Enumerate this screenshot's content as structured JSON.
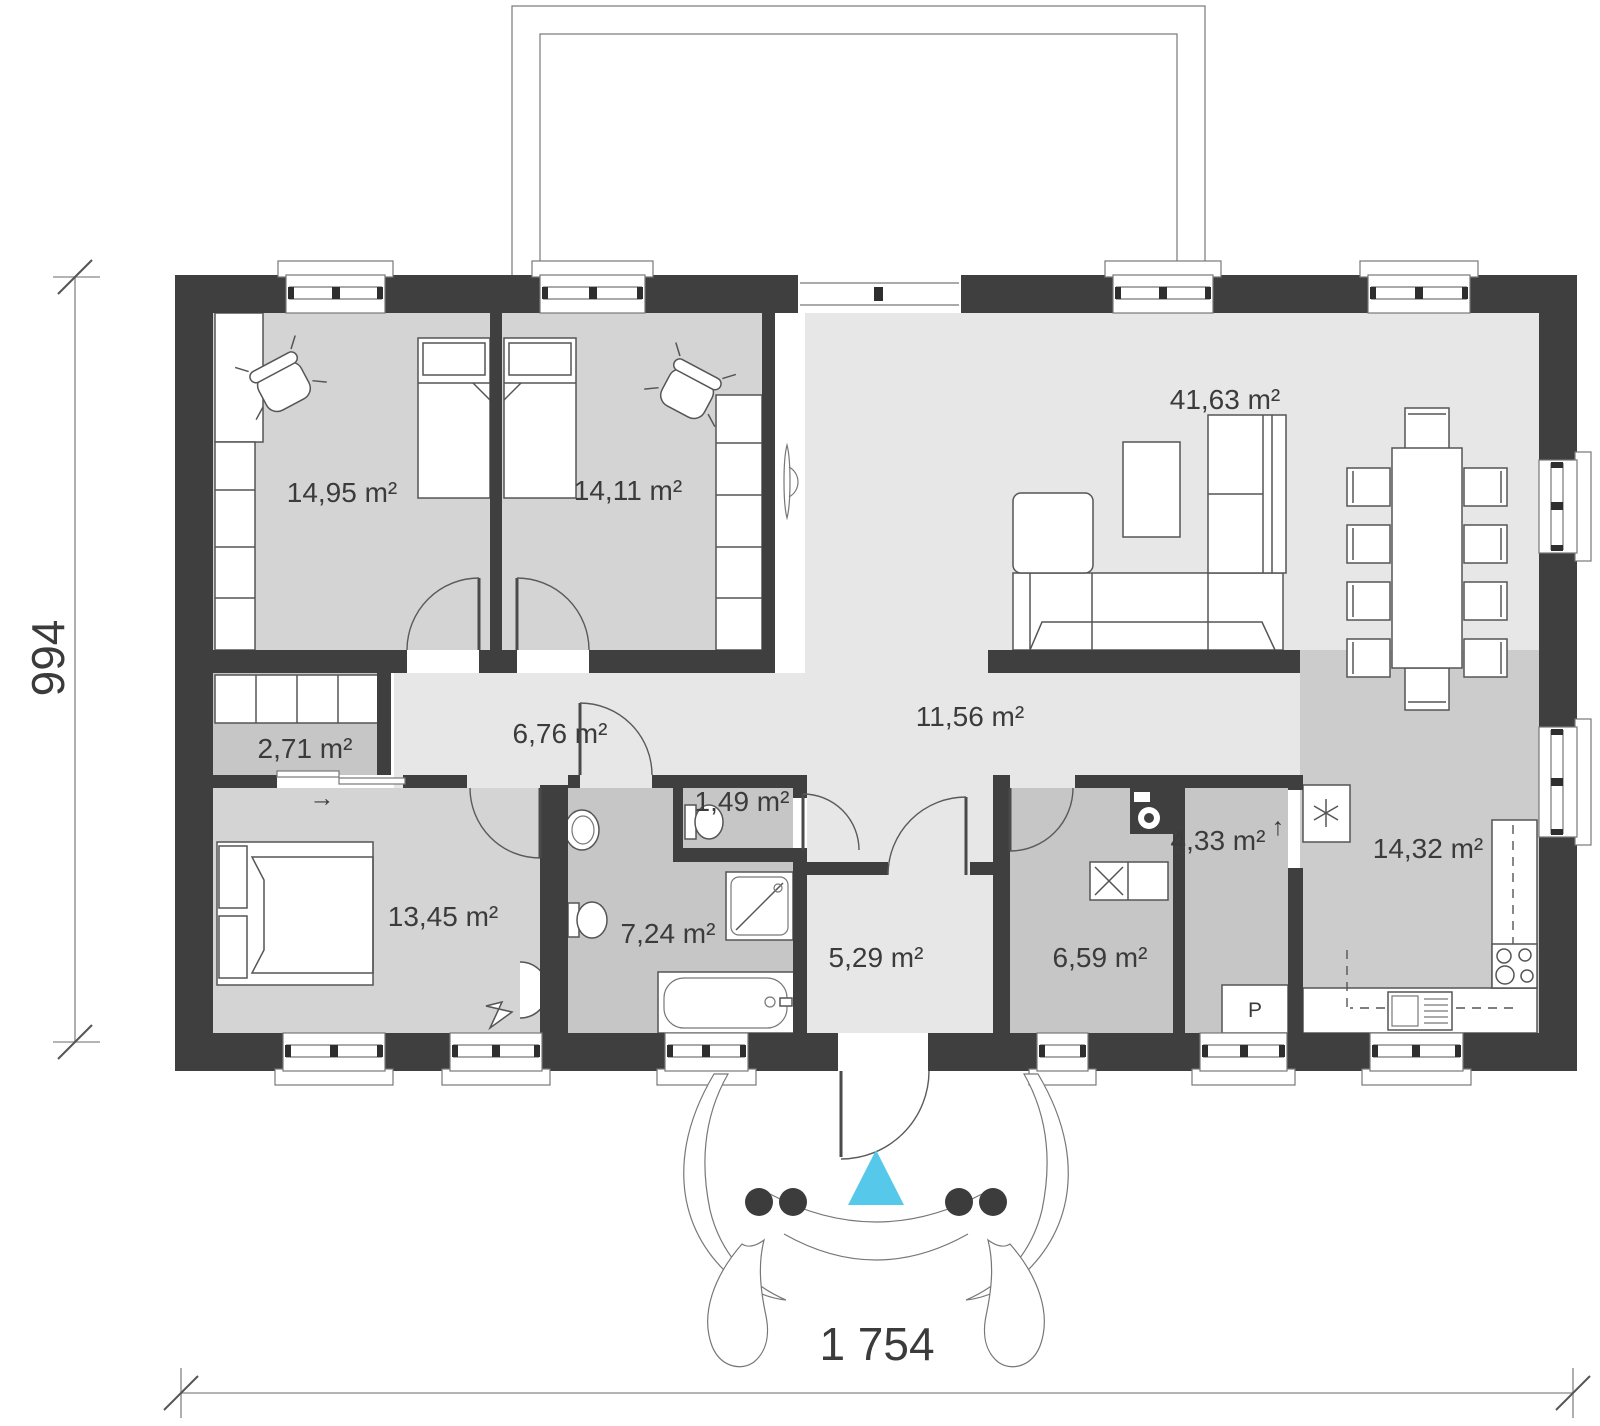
{
  "drawing": {
    "kind": "house floor plan",
    "rooms": [
      {
        "id": "bedroom-1",
        "area_label": "14,95 m²"
      },
      {
        "id": "bedroom-2",
        "area_label": "14,11 m²"
      },
      {
        "id": "living-dining",
        "area_label": "41,63 m²"
      },
      {
        "id": "wardrobe",
        "area_label": "2,71 m²"
      },
      {
        "id": "corridor",
        "area_label": "6,76 m²"
      },
      {
        "id": "hall",
        "area_label": "11,56 m²"
      },
      {
        "id": "wc",
        "area_label": "1,49 m²"
      },
      {
        "id": "master-bedroom",
        "area_label": "13,45 m²"
      },
      {
        "id": "bathroom",
        "area_label": "7,24 m²"
      },
      {
        "id": "entry",
        "area_label": "5,29 m²"
      },
      {
        "id": "utility",
        "area_label": "6,59 m²"
      },
      {
        "id": "pantry",
        "area_label": "4,33 m²"
      },
      {
        "id": "kitchen",
        "area_label": "14,32 m²"
      }
    ],
    "dimensions": {
      "overall_width": "1 754",
      "overall_depth": "994"
    },
    "symbols": {
      "pantry_cabinet": "P",
      "wardrobe_slide_arrow": "→",
      "pantry_arrow": "↑"
    },
    "icons": [
      {
        "name": "entrance-marker-icon",
        "shape": "triangle"
      },
      {
        "name": "fridge-icon",
        "shape": "asterisk"
      },
      {
        "name": "washing-machine-icon",
        "shape": "dark square with circle"
      },
      {
        "name": "stove-icon",
        "shape": "4 burner circles"
      }
    ],
    "colors": {
      "wall": "#3f3f3f",
      "floor_light": "#e6e7e6",
      "floor_mid": "#d3d4d3",
      "floor_dark": "#c5c6c5",
      "floor_kitchen": "#cbcccb",
      "entrance_marker": "#56c9ea"
    }
  }
}
